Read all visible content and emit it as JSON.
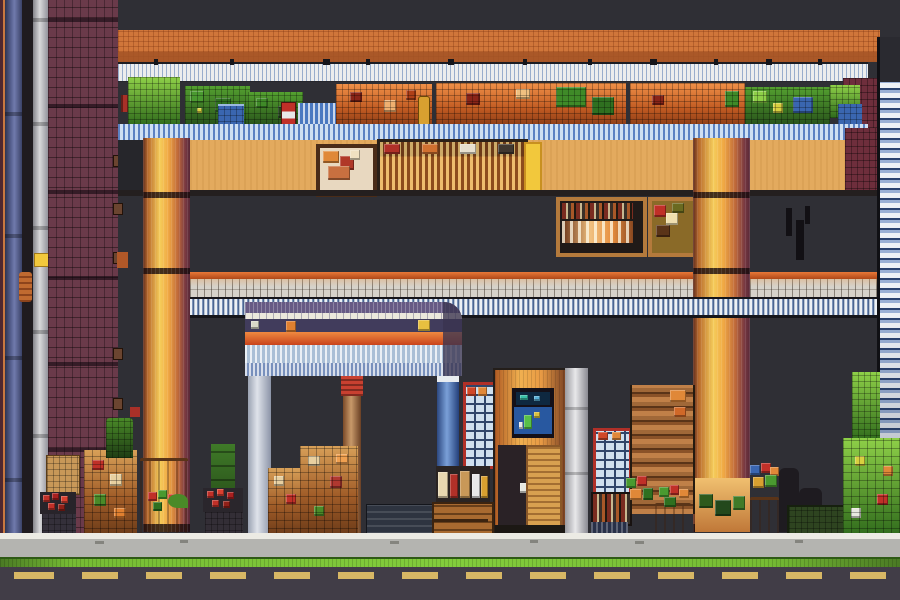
{
  "app": {
    "name": "Pixel Market Street",
    "view": "side-view pixel-art storefront scene",
    "visible_text": "none"
  },
  "palette": {
    "bg": "#2f2f35",
    "roof": "#d0763a",
    "roofShade": "#a35426",
    "slatWhite": "#eceded",
    "shelfBlue": "#cfe0f2",
    "wallTan": "#e3aa5e",
    "wallMaroon": "#6e2e3c",
    "brick": "#6a3a4a",
    "columnGold": "#f5cc5a",
    "beamOrange": "#d05a28",
    "kioskPurple": "#675a84",
    "kioskStripe": "#ece8dc",
    "kioskRed": "#e06830",
    "pillarGray": "#dfe3ea",
    "pillarBlue": "#4a6aa8",
    "cabinetOrange": "#e89a44",
    "screenBlue": "#2858a0",
    "screenTeal": "#38c0a8",
    "paneBlue": "#cfe0ee",
    "paneRed": "#b03028",
    "barrelTan": "#d8a860",
    "leafBright": "#7ac040",
    "leafDark": "#2e5a1c",
    "berryRed": "#c03028",
    "accentYellow": "#f2c83c",
    "curb": "#ecebe4",
    "sidewalk": "#b4b4b0",
    "grass": "#7cc238",
    "road": "#413d47",
    "laneDash": "#e8c468"
  },
  "scene": {
    "background": "dark slate gray interior shadow",
    "structures": [
      {
        "name": "orange-tiled-awning",
        "desc": "long orange brick-textured roof across the top"
      },
      {
        "name": "white-slat-fascia",
        "desc": "white/blue slatted fascia with small dark bird marks"
      },
      {
        "name": "produce-shelf-row",
        "desc": "upper shelf packed with green and orange produce crates and blue boxes"
      },
      {
        "name": "blue-slat-shelf-edge",
        "desc": "blue slatted shelf lip under the produce row"
      },
      {
        "name": "tan-storefront-wall",
        "desc": "tan wall band with framed picture, bottle shelf and yellow door panel"
      },
      {
        "name": "maroon-brick-column",
        "desc": "tall maroon brick pillar on the left edge"
      },
      {
        "name": "gold-column-left",
        "desc": "glowing gold/orange column"
      },
      {
        "name": "gold-column-right",
        "desc": "glowing gold/orange column"
      },
      {
        "name": "crossbeam",
        "desc": "gray slatted crossbeam with orange trim spanning the scene"
      },
      {
        "name": "kiosk-canopy",
        "desc": "purple canopy with white stripe, red-orange band and blue slats on three pillars"
      },
      {
        "name": "vending-cabinet",
        "desc": "orange cabinet with dark bezel and blue pixel screen"
      },
      {
        "name": "window-blind-tower",
        "desc": "tall blue/white horizontal-slat tower on right edge"
      },
      {
        "name": "blue-edge-pillar",
        "desc": "slate blue pillar on far left edge"
      },
      {
        "name": "gray-edge-pillar",
        "desc": "light gray pillar strip on far left"
      }
    ],
    "props": [
      {
        "name": "wall-picture-frame",
        "desc": "small framed warm-toned artwork"
      },
      {
        "name": "wall-bottle-shelf",
        "desc": "long framed shelf of bottles"
      },
      {
        "name": "yellow-door-panel",
        "desc": "narrow bright yellow panel"
      },
      {
        "name": "book-bottle-shelf",
        "desc": "framed shelf with book spines and lit bottles"
      },
      {
        "name": "mosaic-box",
        "desc": "framed box of warm mosaic squares"
      },
      {
        "name": "pane-tower-left",
        "desc": "red-framed blue window-pane stack"
      },
      {
        "name": "pane-tower-right",
        "desc": "red-framed blue window-pane stack"
      },
      {
        "name": "plank-shelf",
        "desc": "wooden plank shelving"
      },
      {
        "name": "barrels",
        "desc": "tan barrels topped with produce"
      },
      {
        "name": "produce-crates",
        "desc": "stacked crates of fruit, berries and bottles"
      },
      {
        "name": "plants",
        "desc": "dark green plants, planter box and bright foliage stack"
      },
      {
        "name": "bench",
        "desc": "dark slatted bench"
      }
    ],
    "street_bands": [
      {
        "name": "curb-line",
        "desc": "white curb top line"
      },
      {
        "name": "sidewalk",
        "desc": "gray sidewalk"
      },
      {
        "name": "grass-strip",
        "desc": "bright green strip"
      },
      {
        "name": "road",
        "desc": "dark asphalt"
      },
      {
        "name": "lane-line",
        "desc": "yellow dashed lane markings"
      }
    ]
  }
}
